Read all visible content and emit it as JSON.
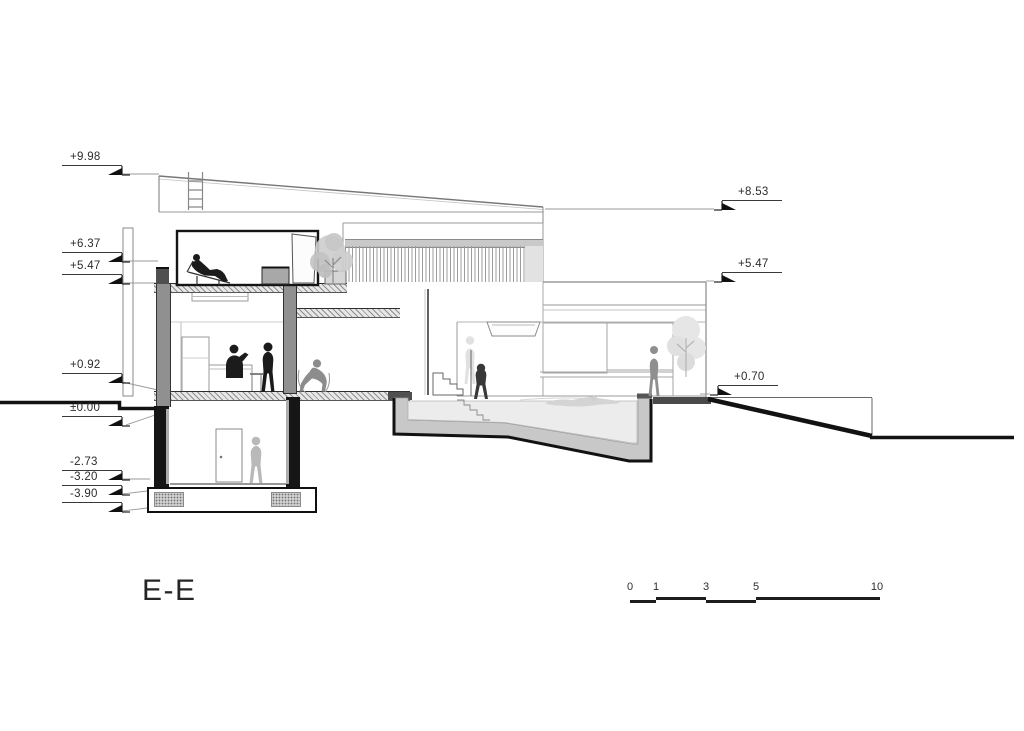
{
  "document": {
    "type": "architectural-section-drawing",
    "section_label": "E-E"
  },
  "title": {
    "label": "E-E"
  },
  "elevation_markers": {
    "left": [
      {
        "label": "+9.98"
      },
      {
        "label": "+6.37"
      },
      {
        "label": "+5.47"
      },
      {
        "label": "+0.92"
      },
      {
        "label": "±0.00"
      },
      {
        "label": "-2.73"
      },
      {
        "label": "-3.20"
      },
      {
        "label": "-3.90"
      }
    ],
    "right": [
      {
        "label": "+8.53"
      },
      {
        "label": "+5.47"
      },
      {
        "label": "+0.70"
      }
    ]
  },
  "scale_bar": {
    "labels": [
      "0",
      "1",
      "3",
      "5",
      "10"
    ]
  },
  "colors": {
    "background": "#ffffff",
    "line_dark": "#161616",
    "line_medium": "#8a8a8a",
    "line_light": "#c0c0c0",
    "cut_wall_gray": "#8f8f8f",
    "water": "#ececec",
    "pool_concrete": "#c8c8c8",
    "figure_black": "#1b1b1b",
    "figure_gray": "#8c8c8c",
    "figure_light": "#d8d8d8"
  },
  "icons": {
    "level_flag": "level-flag-icon",
    "ladder": "ladder-icon",
    "figures": [
      "person-lounging",
      "person-kitchen",
      "person-standing",
      "person-sitting",
      "person-ghost",
      "person-walking",
      "person-swimming",
      "person-standing-right",
      "person-basement"
    ],
    "trees": [
      "terrace-tree",
      "garden-tree"
    ]
  }
}
